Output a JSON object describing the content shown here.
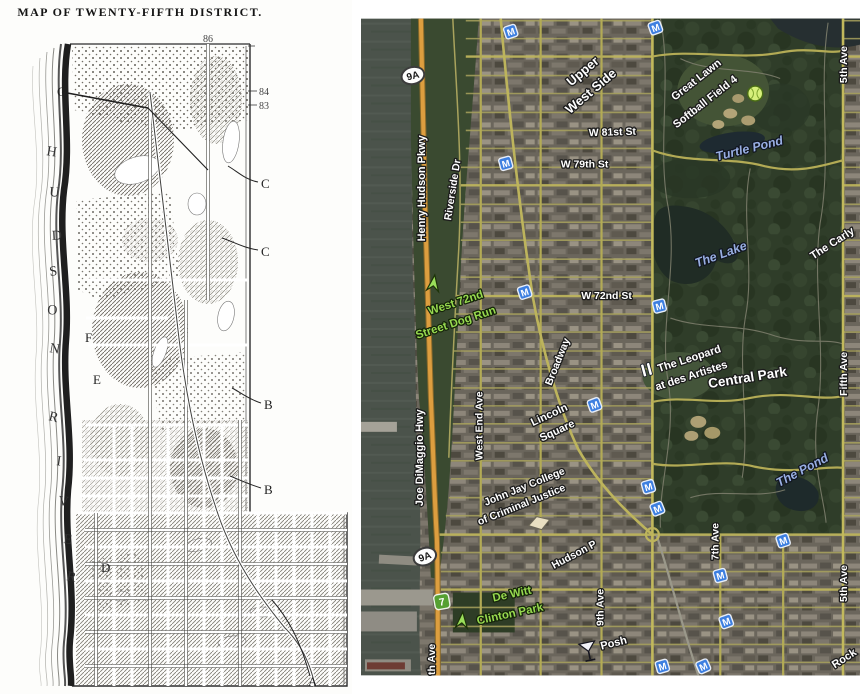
{
  "left_map": {
    "title": "MAP OF TWENTY-FIFTH DISTRICT.",
    "numbers": {
      "top": "86",
      "mid": "84",
      "low": "83"
    },
    "hudson_letters": [
      "H",
      "U",
      "D",
      "S",
      "O",
      "N"
    ],
    "river_letters": [
      "R",
      "I",
      "V",
      "E",
      "R"
    ],
    "ref_letters": {
      "g": "G",
      "f": "F",
      "e": "E",
      "d": "D",
      "c1": "C",
      "c2": "C",
      "b1": "B",
      "b2": "B",
      "a": "A"
    }
  },
  "right_map": {
    "markers": {
      "subway_m": "M",
      "route_9a": "9A",
      "line_7": "7"
    },
    "streets": {
      "w81": "W 81st St",
      "w79": "W 79th St",
      "w72": "W 72nd St",
      "henry_hudson": "Henry Hudson Pkwy",
      "riverside": "Riverside Dr",
      "joe_dimaggio": "Joe DiMaggio Hwy",
      "west_end": "West End Ave",
      "broadway": "Broadway",
      "hudson_partial": "Hudson P",
      "ninth_ave": "9th Ave",
      "partial_ave": "th Ave",
      "seventh_ave": "7th Ave",
      "fifth_ave_top": "5th Ave",
      "fifth_ave_mid": "Fifth Ave",
      "fifth_ave_bottom": "5th Ave",
      "rock_partial": "Rock"
    },
    "areas": {
      "upper_west_1": "Upper",
      "upper_west_2": "West Side",
      "lincoln_1": "Lincoln",
      "lincoln_2": "Square",
      "central_park": "Central Park"
    },
    "water": {
      "turtle_pond": "Turtle Pond",
      "the_lake": "The Lake",
      "the_pond": "The Pond"
    },
    "places": {
      "great_lawn_1": "Great Lawn",
      "great_lawn_2": "Softball Field 4",
      "leopard_1": "The Leopard",
      "leopard_2": "at des Artistes",
      "john_jay_1": "John Jay College",
      "john_jay_2": "of Criminal Justice",
      "dog_run_1": "West 72nd",
      "dog_run_2": "Street Dog Run",
      "dewitt_1": "De Witt",
      "dewitt_2": "Clinton Park",
      "posh": "Posh",
      "carlyle_partial": "The Carly"
    }
  },
  "colors": {
    "subway_blue": "#3d7fe0",
    "road_yellow": "#b3ab55",
    "parkway_orange": "#dd9e3f",
    "park_green": "#2f3d29",
    "water_gray": "#4b534b",
    "poi_green_text": "#97d94f",
    "water_label_blue": "#98aee2"
  }
}
